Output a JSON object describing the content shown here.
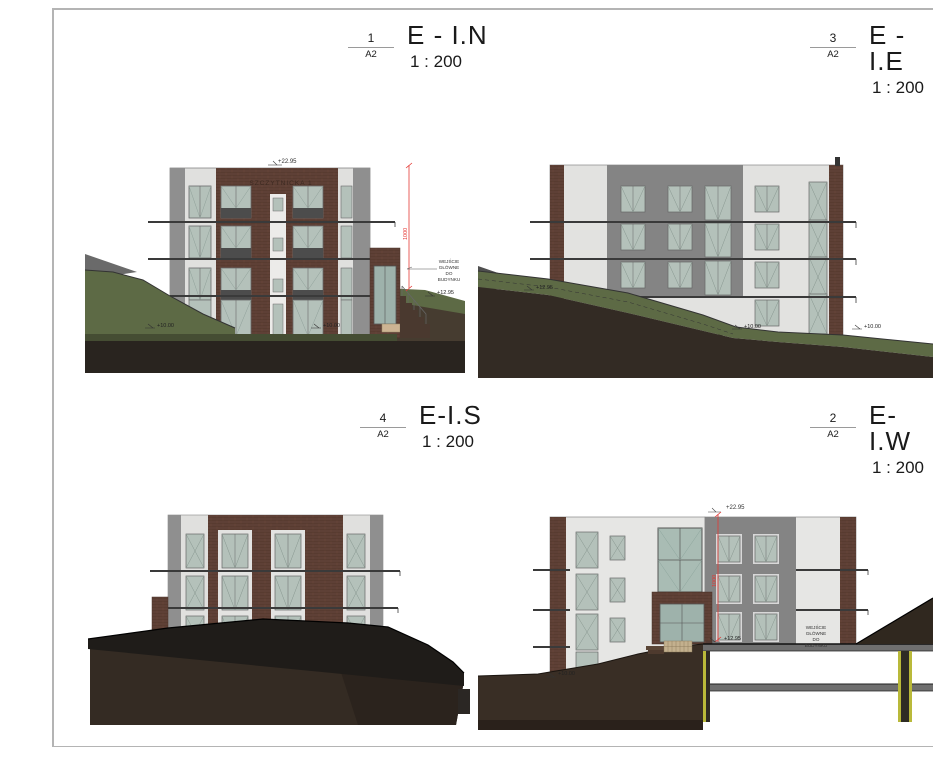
{
  "sheet": {
    "background": "#ffffff",
    "frame_color": "#b4b4b4"
  },
  "titles": {
    "north": {
      "ref_number": "1",
      "ref_sheet": "A2",
      "name": "E - I.N",
      "scale": "1 : 200"
    },
    "east": {
      "ref_number": "3",
      "ref_sheet": "A2",
      "name": "E - I.E",
      "scale": "1 : 200"
    },
    "south": {
      "ref_number": "4",
      "ref_sheet": "A2",
      "name": "E-I.S",
      "scale": "1 : 200"
    },
    "west": {
      "ref_number": "2",
      "ref_sheet": "A2",
      "name": "E-I.W",
      "scale": "1 : 200"
    }
  },
  "annotations": {
    "north": {
      "top_level": "+22.95",
      "vertical_dim": "1000",
      "entrance_level": "+12.95",
      "ground_level_left": "+10.00",
      "ground_level_right": "+10.00",
      "note_lines": [
        "WEJŚCIE",
        "GŁÓWNE",
        "DO",
        "BUDYNKU"
      ],
      "facade_sign": "SZCZYTNICKA 1"
    },
    "east": {
      "terrace_level": "+12.95",
      "ground_level_mid": "+10.00",
      "ground_level_right": "+10.00"
    },
    "south": {},
    "west": {
      "top_level": "+22.95",
      "vertical_dim": "1000",
      "entrance_level": "+12.95",
      "ground_level_left": "+10.00",
      "note_lines": [
        "WEJŚCIE",
        "GŁÓWNE",
        "DO",
        "BUDYNKU"
      ]
    }
  },
  "colors": {
    "brick": "#5e4036",
    "plaster": "#e2e2e0",
    "pilaster_gray": "#8f8f8f",
    "recess_gray": "#848484",
    "glass": "#b4c1ba",
    "panel_dark": "#4c4c4c",
    "grass": "#5d6a45",
    "earth": "#362d25",
    "mound": "#1f1c19",
    "dimension_red": "#e53935",
    "insulation_yellow": "#b9b93a",
    "slab_gray": "#6f6f6f"
  }
}
